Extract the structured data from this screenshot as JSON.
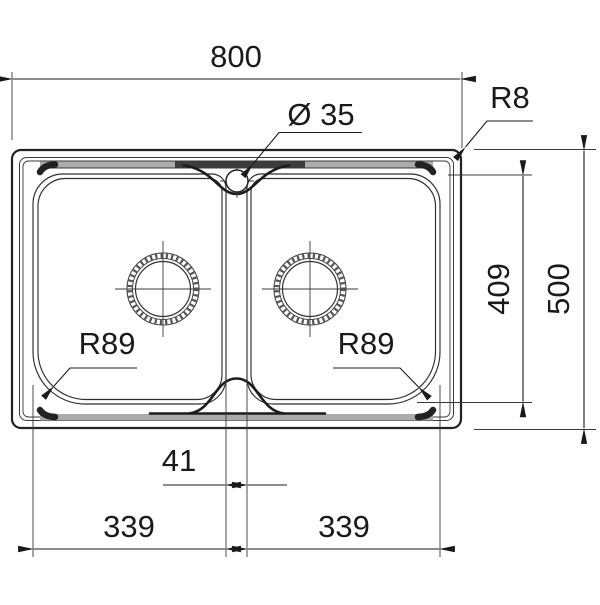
{
  "drawing": {
    "dimensions": {
      "overall_width": "800",
      "overall_depth": "500",
      "inner_depth": "409",
      "center_web_width": "41",
      "left_bowl_width": "339",
      "right_bowl_width": "339",
      "rim_corner_radius": "R8",
      "tap_hole_diameter": "Ø 35",
      "left_bowl_corner_radius": "R89",
      "right_bowl_corner_radius": "R89"
    },
    "colors": {
      "line": "#1a1a1a",
      "rim_band": "#ababab",
      "background": "#ffffff"
    }
  }
}
